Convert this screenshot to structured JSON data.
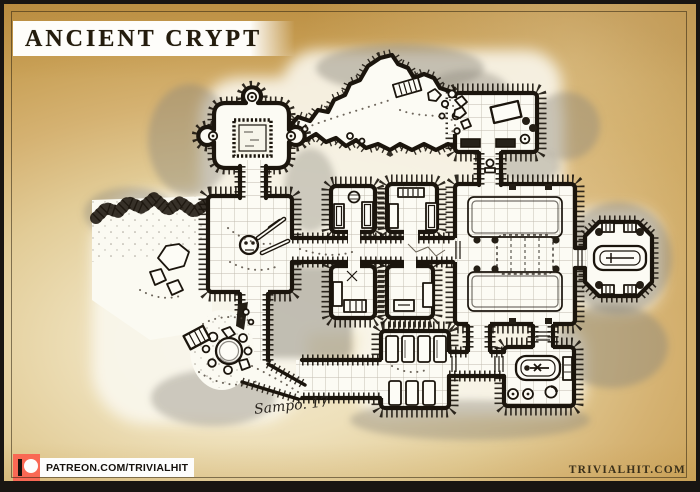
{
  "header": {
    "title": "ANCIENT CRYPT"
  },
  "map": {
    "signature": "Sampo. 17",
    "style": "hand-drawn ink and wash dungeon map on parchment",
    "features": [
      "shrine-room-with-alcoves",
      "dais-altar",
      "bone-room",
      "cave-passages",
      "rubble-pit-cave",
      "crypt-niche-rooms",
      "great-hall-with-platform",
      "octagonal-tomb-vault",
      "sarcophagus",
      "coffin-room",
      "burial-room",
      "collapsed-cave-entrance",
      "ladder",
      "rocks-and-debris"
    ]
  },
  "footer": {
    "patreon_label": "PATREON.COM/TRIVIALHIT",
    "website_label": "TRIVIALHIT.COM"
  },
  "colors": {
    "patreon_red": "#f96854",
    "ink": "#1b150d",
    "parchment_mid": "#d9bc80",
    "parchment_edge": "#bf954a",
    "paper_white": "#fcfbf4",
    "wash_gray": "#8a857a"
  }
}
